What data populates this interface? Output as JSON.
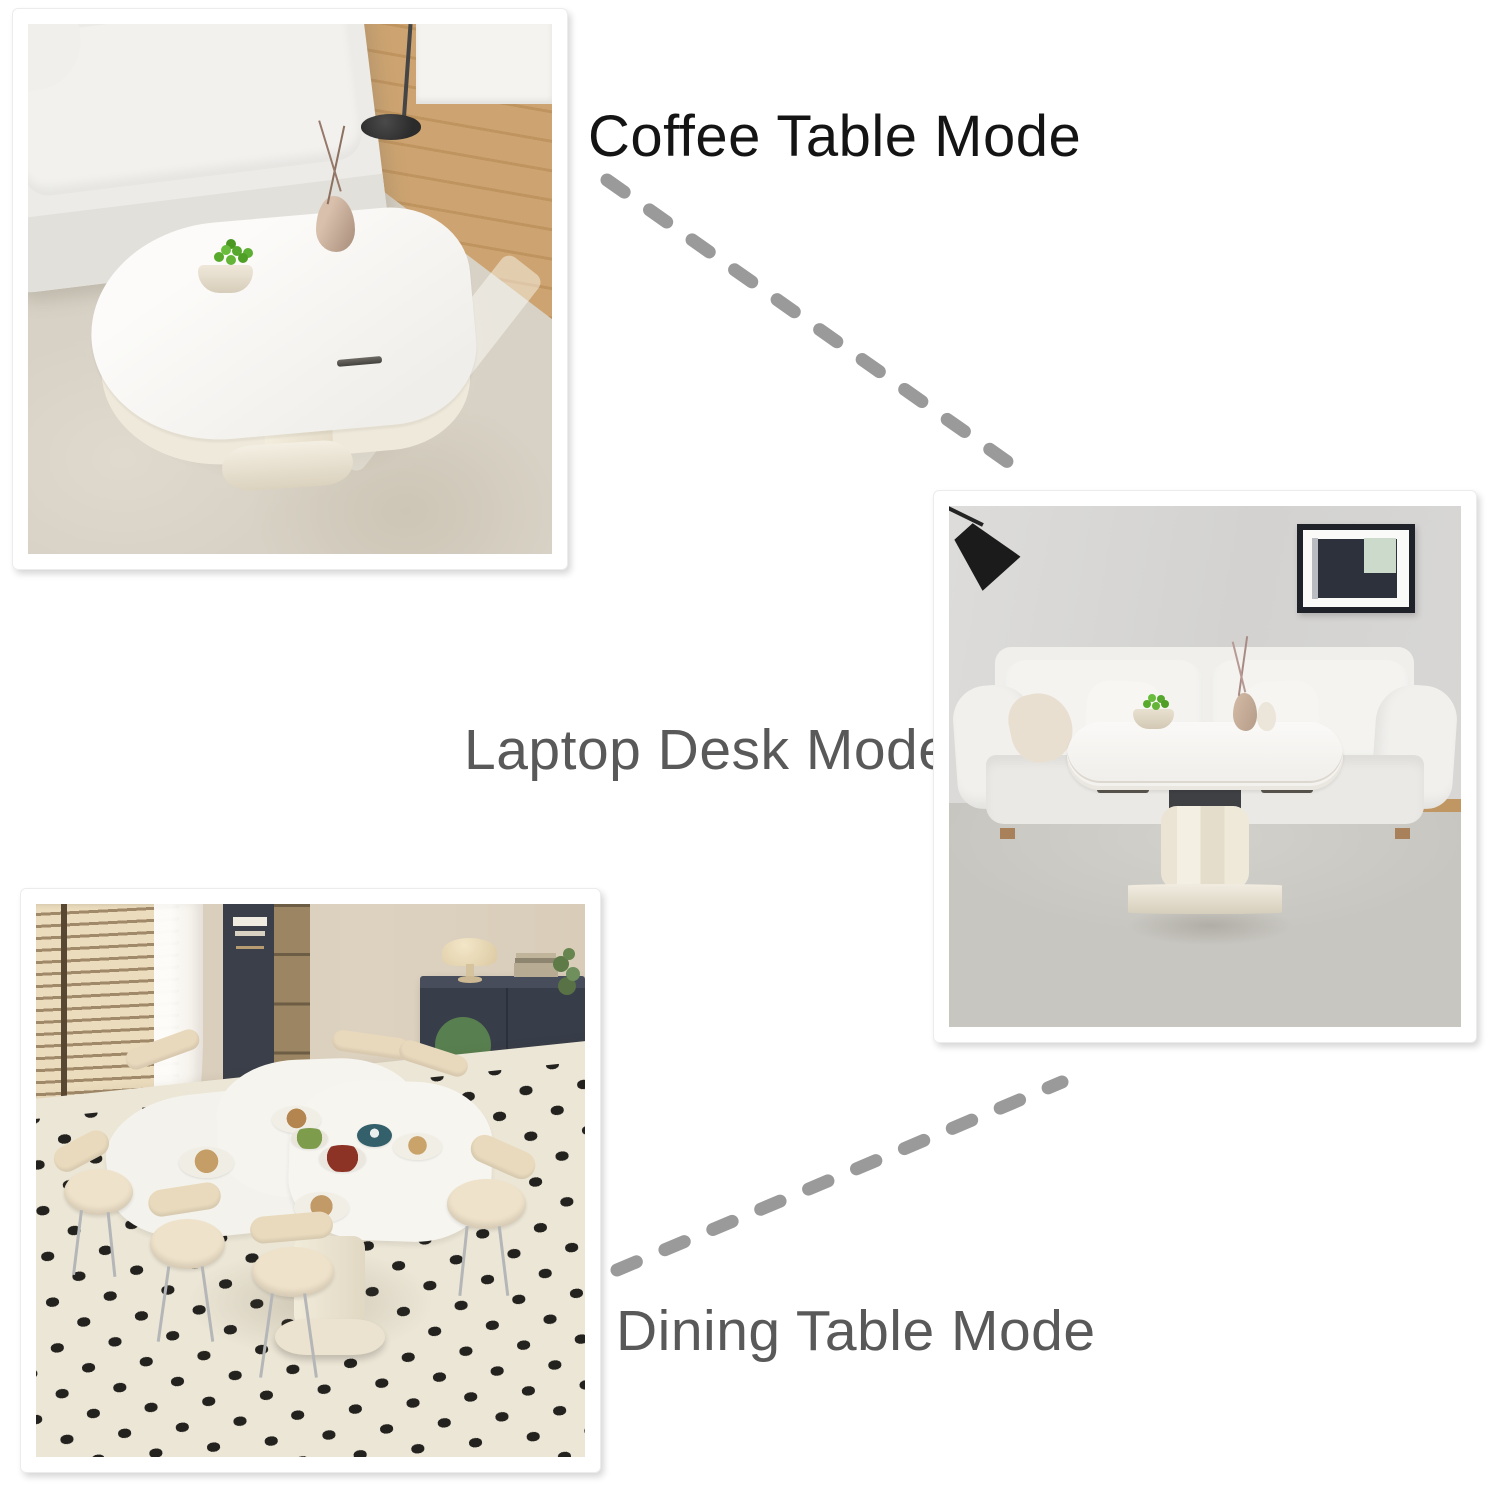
{
  "page": {
    "background_color": "#ffffff"
  },
  "connector": {
    "color": "#9a9a9a",
    "style": "dashed"
  },
  "panels": [
    {
      "id": "coffee-table",
      "label": "Coffee Table Mode",
      "label_color": "#141414",
      "photo_alt": "White lift-top coffee table with a bowl of green apples and a beige vase, beside a cream sofa and black floor lamp on a beige rug"
    },
    {
      "id": "laptop-desk",
      "label": "Laptop Desk Mode",
      "label_color": "#59595a",
      "photo_alt": "Table raised to desk height on its cream pedestal in front of a white sofa, gray wall with framed art and black lamp"
    },
    {
      "id": "dining-table",
      "label": "Dining Table Mode",
      "label_color": "#59595a",
      "photo_alt": "Table expanded into a dining table set with dishes, surrounded by cream chairs on a black-dotted cream rug"
    }
  ]
}
